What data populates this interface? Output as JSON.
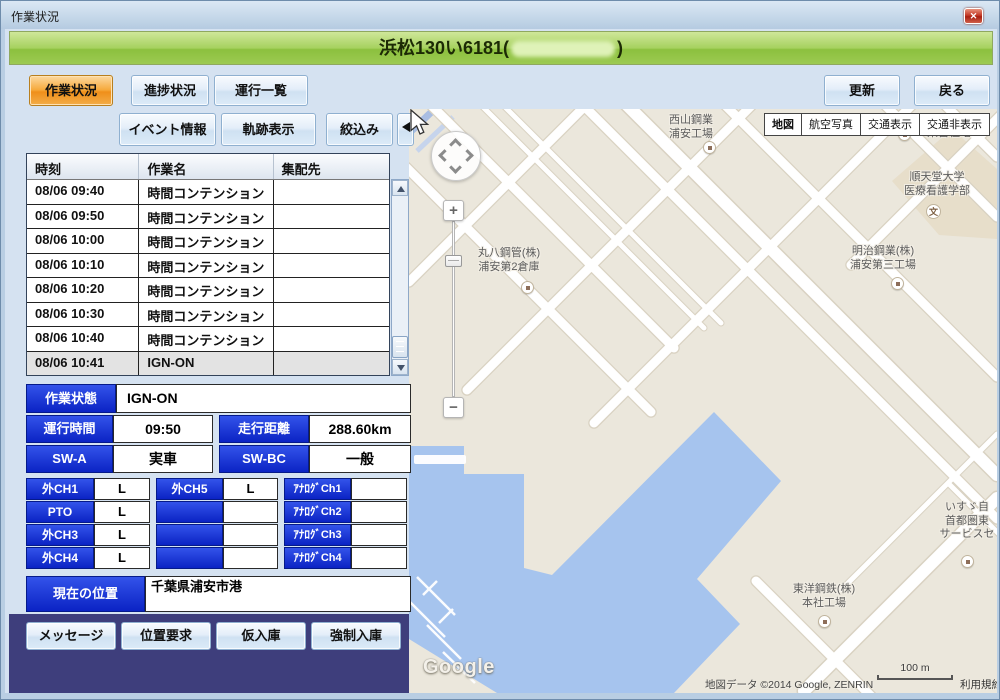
{
  "window": {
    "title": "作業状況",
    "close_glyph": "✕"
  },
  "banner": {
    "prefix": "浜松130い6181(",
    "suffix": ")"
  },
  "tabs": {
    "t0": "作業状況",
    "t1": "進捗状況",
    "t2": "運行一覧"
  },
  "actions": {
    "update": "更新",
    "back": "戻る"
  },
  "tools": {
    "event": "イベント情報",
    "track": "軌跡表示",
    "filter": "絞込み"
  },
  "table": {
    "h0": "時刻",
    "h1": "作業名",
    "h2": "集配先",
    "rows": [
      {
        "time": "08/06 09:40",
        "work": "時間コンテンション",
        "dest": ""
      },
      {
        "time": "08/06 09:50",
        "work": "時間コンテンション",
        "dest": ""
      },
      {
        "time": "08/06 10:00",
        "work": "時間コンテンション",
        "dest": ""
      },
      {
        "time": "08/06 10:10",
        "work": "時間コンテンション",
        "dest": ""
      },
      {
        "time": "08/06 10:20",
        "work": "時間コンテンション",
        "dest": ""
      },
      {
        "time": "08/06 10:30",
        "work": "時間コンテンション",
        "dest": ""
      },
      {
        "time": "08/06 10:40",
        "work": "時間コンテンション",
        "dest": ""
      },
      {
        "time": "08/06 10:41",
        "work": "IGN-ON",
        "dest": ""
      }
    ]
  },
  "status": {
    "work_state_label": "作業状態",
    "work_state": "IGN-ON",
    "run_time_label": "運行時間",
    "run_time": "09:50",
    "distance_label": "走行距離",
    "distance": "288.60km",
    "sw_a_label": "SW-A",
    "sw_a": "実車",
    "sw_bc_label": "SW-BC",
    "sw_bc": "一般"
  },
  "channels": {
    "r0": {
      "l0": "外CH1",
      "v0": "L",
      "l1": "外CH5",
      "v1": "L",
      "l2": "ｱﾅﾛｸﾞCh1",
      "v2": ""
    },
    "r1": {
      "l0": "PTO",
      "v0": "L",
      "l1": "",
      "v1": "",
      "l2": "ｱﾅﾛｸﾞCh2",
      "v2": ""
    },
    "r2": {
      "l0": "外CH3",
      "v0": "L",
      "l1": "",
      "v1": "",
      "l2": "ｱﾅﾛｸﾞCh3",
      "v2": ""
    },
    "r3": {
      "l0": "外CH4",
      "v0": "L",
      "l1": "",
      "v1": "",
      "l2": "ｱﾅﾛｸﾞCh4",
      "v2": ""
    }
  },
  "location": {
    "label": "現在の位置",
    "value": "千葉県浦安市港"
  },
  "bottom": {
    "b0": "メッセージ",
    "b1": "位置要求",
    "b2": "仮入庫",
    "b3": "強制入庫"
  },
  "map": {
    "modes": {
      "m0": "地図",
      "m1": "航空写真",
      "m2": "交通表示",
      "m3": "交通非表示"
    },
    "zoom": {
      "plus": "+",
      "minus": "−"
    },
    "labels": {
      "nishiyama": {
        "l1": "西山鋼業",
        "l2": "浦安工場"
      },
      "kenei": {
        "l1": "県営住宅"
      },
      "juntendo": {
        "l1": "順天堂大学",
        "l2": "医療看護学部"
      },
      "meiji": {
        "l1": "明治鋼業(株)",
        "l2": "浦安第三工場"
      },
      "maruhachi": {
        "l1": "丸八鋼管(株)",
        "l2": "浦安第2倉庫"
      },
      "toyo": {
        "l1": "東洋鋼鉄(株)",
        "l2": "本社工場"
      },
      "isuzu": {
        "l1": "いすゞ自",
        "l2": "首都圏東",
        "l3": "サービスセ"
      },
      "school_icon": "文"
    },
    "attribution": {
      "copyright": "地図データ ©2014 Google, ZENRIN",
      "scale": "100 m",
      "terms": "利用規約",
      "logo": "Google"
    },
    "colors": {
      "water": "#a6c4ee",
      "land": "#ebe7dc",
      "road": "#ffffff",
      "campus": "#e7decа"
    }
  }
}
